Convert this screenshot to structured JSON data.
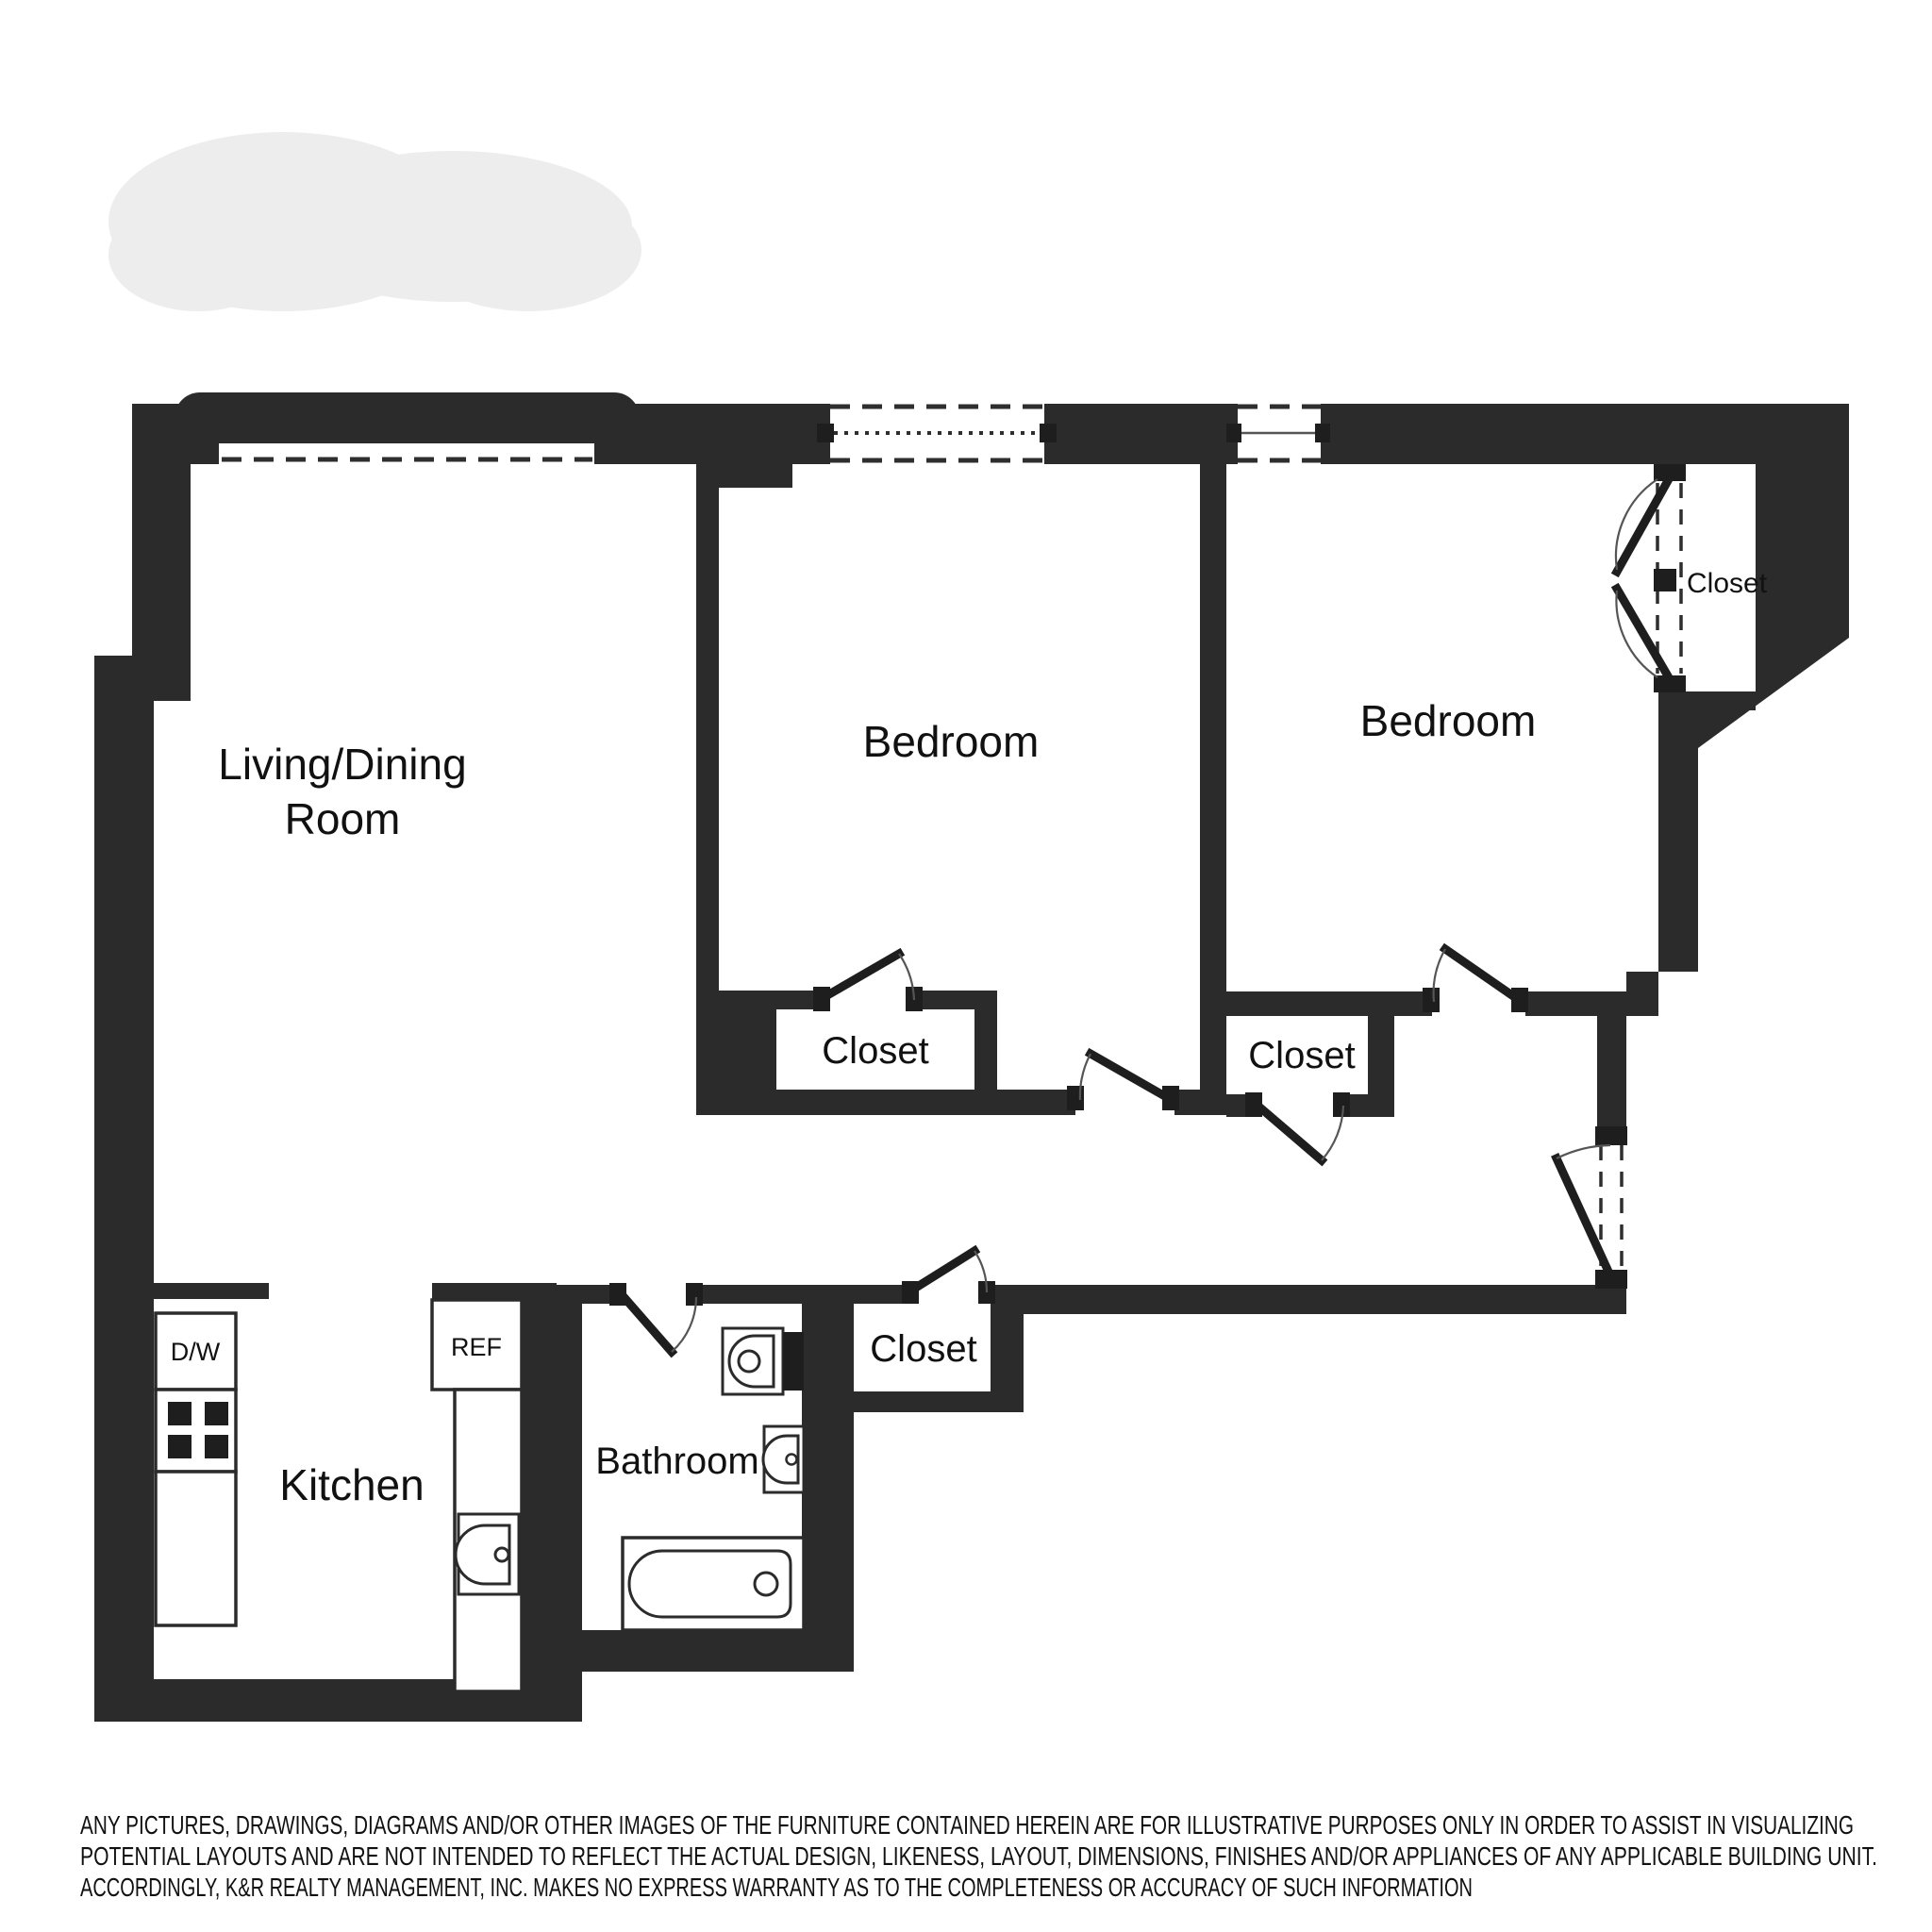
{
  "floor_plan": {
    "colors": {
      "wall": "#2b2b2b",
      "background": "#ffffff"
    },
    "rooms": {
      "living_dining": {
        "label_line1": "Living/Dining",
        "label_line2": "Room"
      },
      "bedroom_left": {
        "label": "Bedroom"
      },
      "bedroom_right": {
        "label": "Bedroom"
      },
      "kitchen": {
        "label": "Kitchen"
      },
      "bathroom": {
        "label": "Bathroom"
      }
    },
    "closets": {
      "bedroom_left_closet": "Closet",
      "hall_closet_by_bedroom": "Closet",
      "hall_closet_south": "Closet",
      "corner_bifold_closet": "Closet"
    },
    "appliances": {
      "dishwasher": "D/W",
      "refrigerator": "REF"
    }
  },
  "disclaimer": {
    "line1": "ANY PICTURES, DRAWINGS, DIAGRAMS AND/OR OTHER IMAGES OF THE FURNITURE CONTAINED HEREIN ARE FOR ILLUSTRATIVE PURPOSES ONLY IN ORDER TO ASSIST IN VISUALIZING",
    "line2": "POTENTIAL LAYOUTS AND ARE NOT INTENDED TO REFLECT THE ACTUAL DESIGN, LIKENESS, LAYOUT, DIMENSIONS, FINISHES AND/OR APPLIANCES OF ANY APPLICABLE BUILDING UNIT.",
    "line3": "ACCORDINGLY, K&R REALTY MANAGEMENT, INC. MAKES NO EXPRESS WARRANTY AS TO THE COMPLETENESS OR ACCURACY OF SUCH INFORMATION"
  }
}
